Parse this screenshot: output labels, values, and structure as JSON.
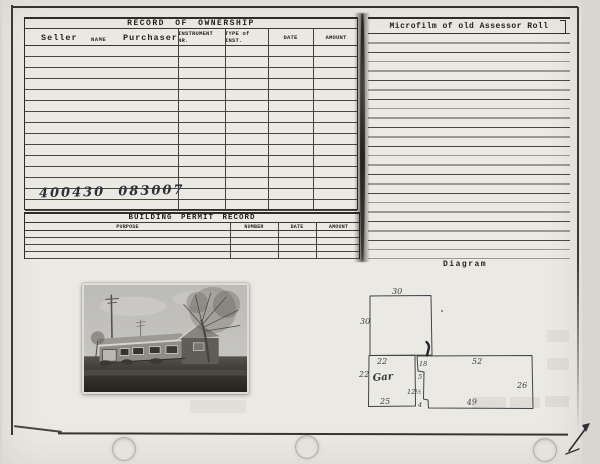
{
  "ownership": {
    "title": "RECORD OF OWNERSHIP",
    "seller": "Seller",
    "name_label": "NAME",
    "purchaser": "Purchaser",
    "instrument_nr": "INSTRUMENT NR.",
    "type_of_inst": "TYPE of INST.",
    "date": "DATE",
    "amount": "AMOUNT",
    "handwritten_parcel": "400430  083007"
  },
  "permit": {
    "title": "BUILDING PERMIT RECORD",
    "purpose": "PURPOSE",
    "number": "NUMBER",
    "date": "DATE",
    "amount": "AMOUNT"
  },
  "microfilm": {
    "title": "Microfilm of old Assessor Roll"
  },
  "diagram": {
    "title": "Diagram",
    "labels": {
      "upper_width": "30",
      "upper_height": "30",
      "garage_width": "22",
      "garage_height": "22",
      "garage_name": "Gar",
      "garage_bottom": "25",
      "seg_18": "18",
      "seg_5": "5",
      "seg_12half": "12½",
      "seg_4": "4",
      "main_width": "52",
      "main_height": "26",
      "main_bottom": "49"
    }
  },
  "colors": {
    "card_background": "#ebe9e3",
    "rule_line": "#4a4741",
    "printed_ink": "#211f1b",
    "handwriting_ink": "#33363c"
  }
}
